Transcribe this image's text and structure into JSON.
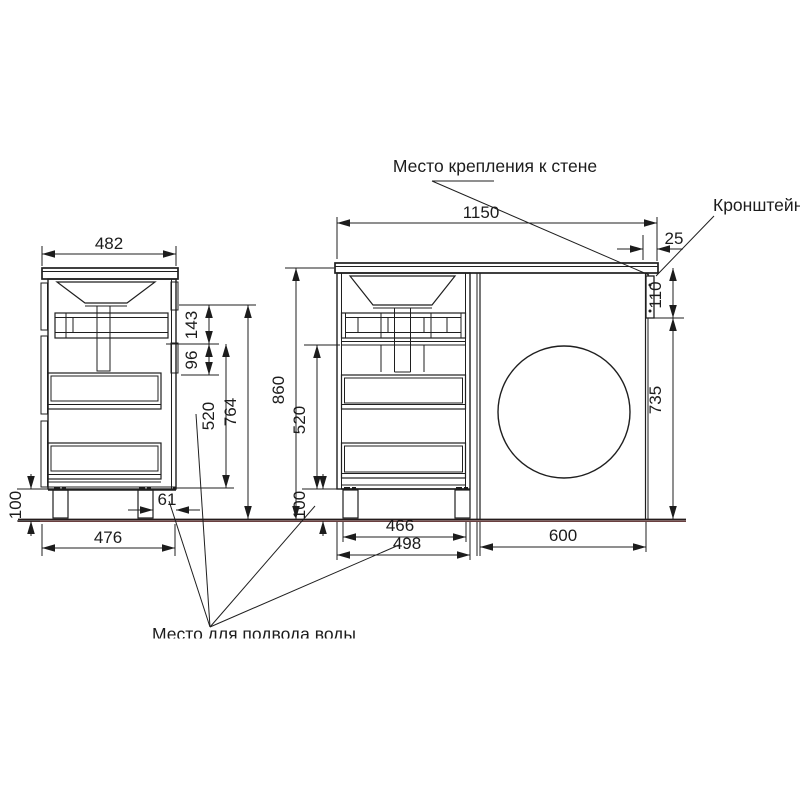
{
  "labels": {
    "wall_mount": "Место крепления к стене",
    "bracket": "Кронштейн",
    "water_supply": "Место для подвода воды"
  },
  "sv": {
    "d482": "482",
    "d143": "143",
    "d96": "96",
    "d520": "520",
    "d764": "764",
    "d100": "100",
    "d61": "61",
    "d476": "476"
  },
  "fv": {
    "d1150": "1150",
    "d25": "25",
    "d110": "110",
    "d735": "735",
    "d860": "860",
    "d520": "520",
    "d100": "100",
    "d466": "466",
    "d498": "498",
    "d600": "600"
  },
  "colors": {
    "line": "#1f1f1f",
    "floor_accent": "#6a4040"
  }
}
